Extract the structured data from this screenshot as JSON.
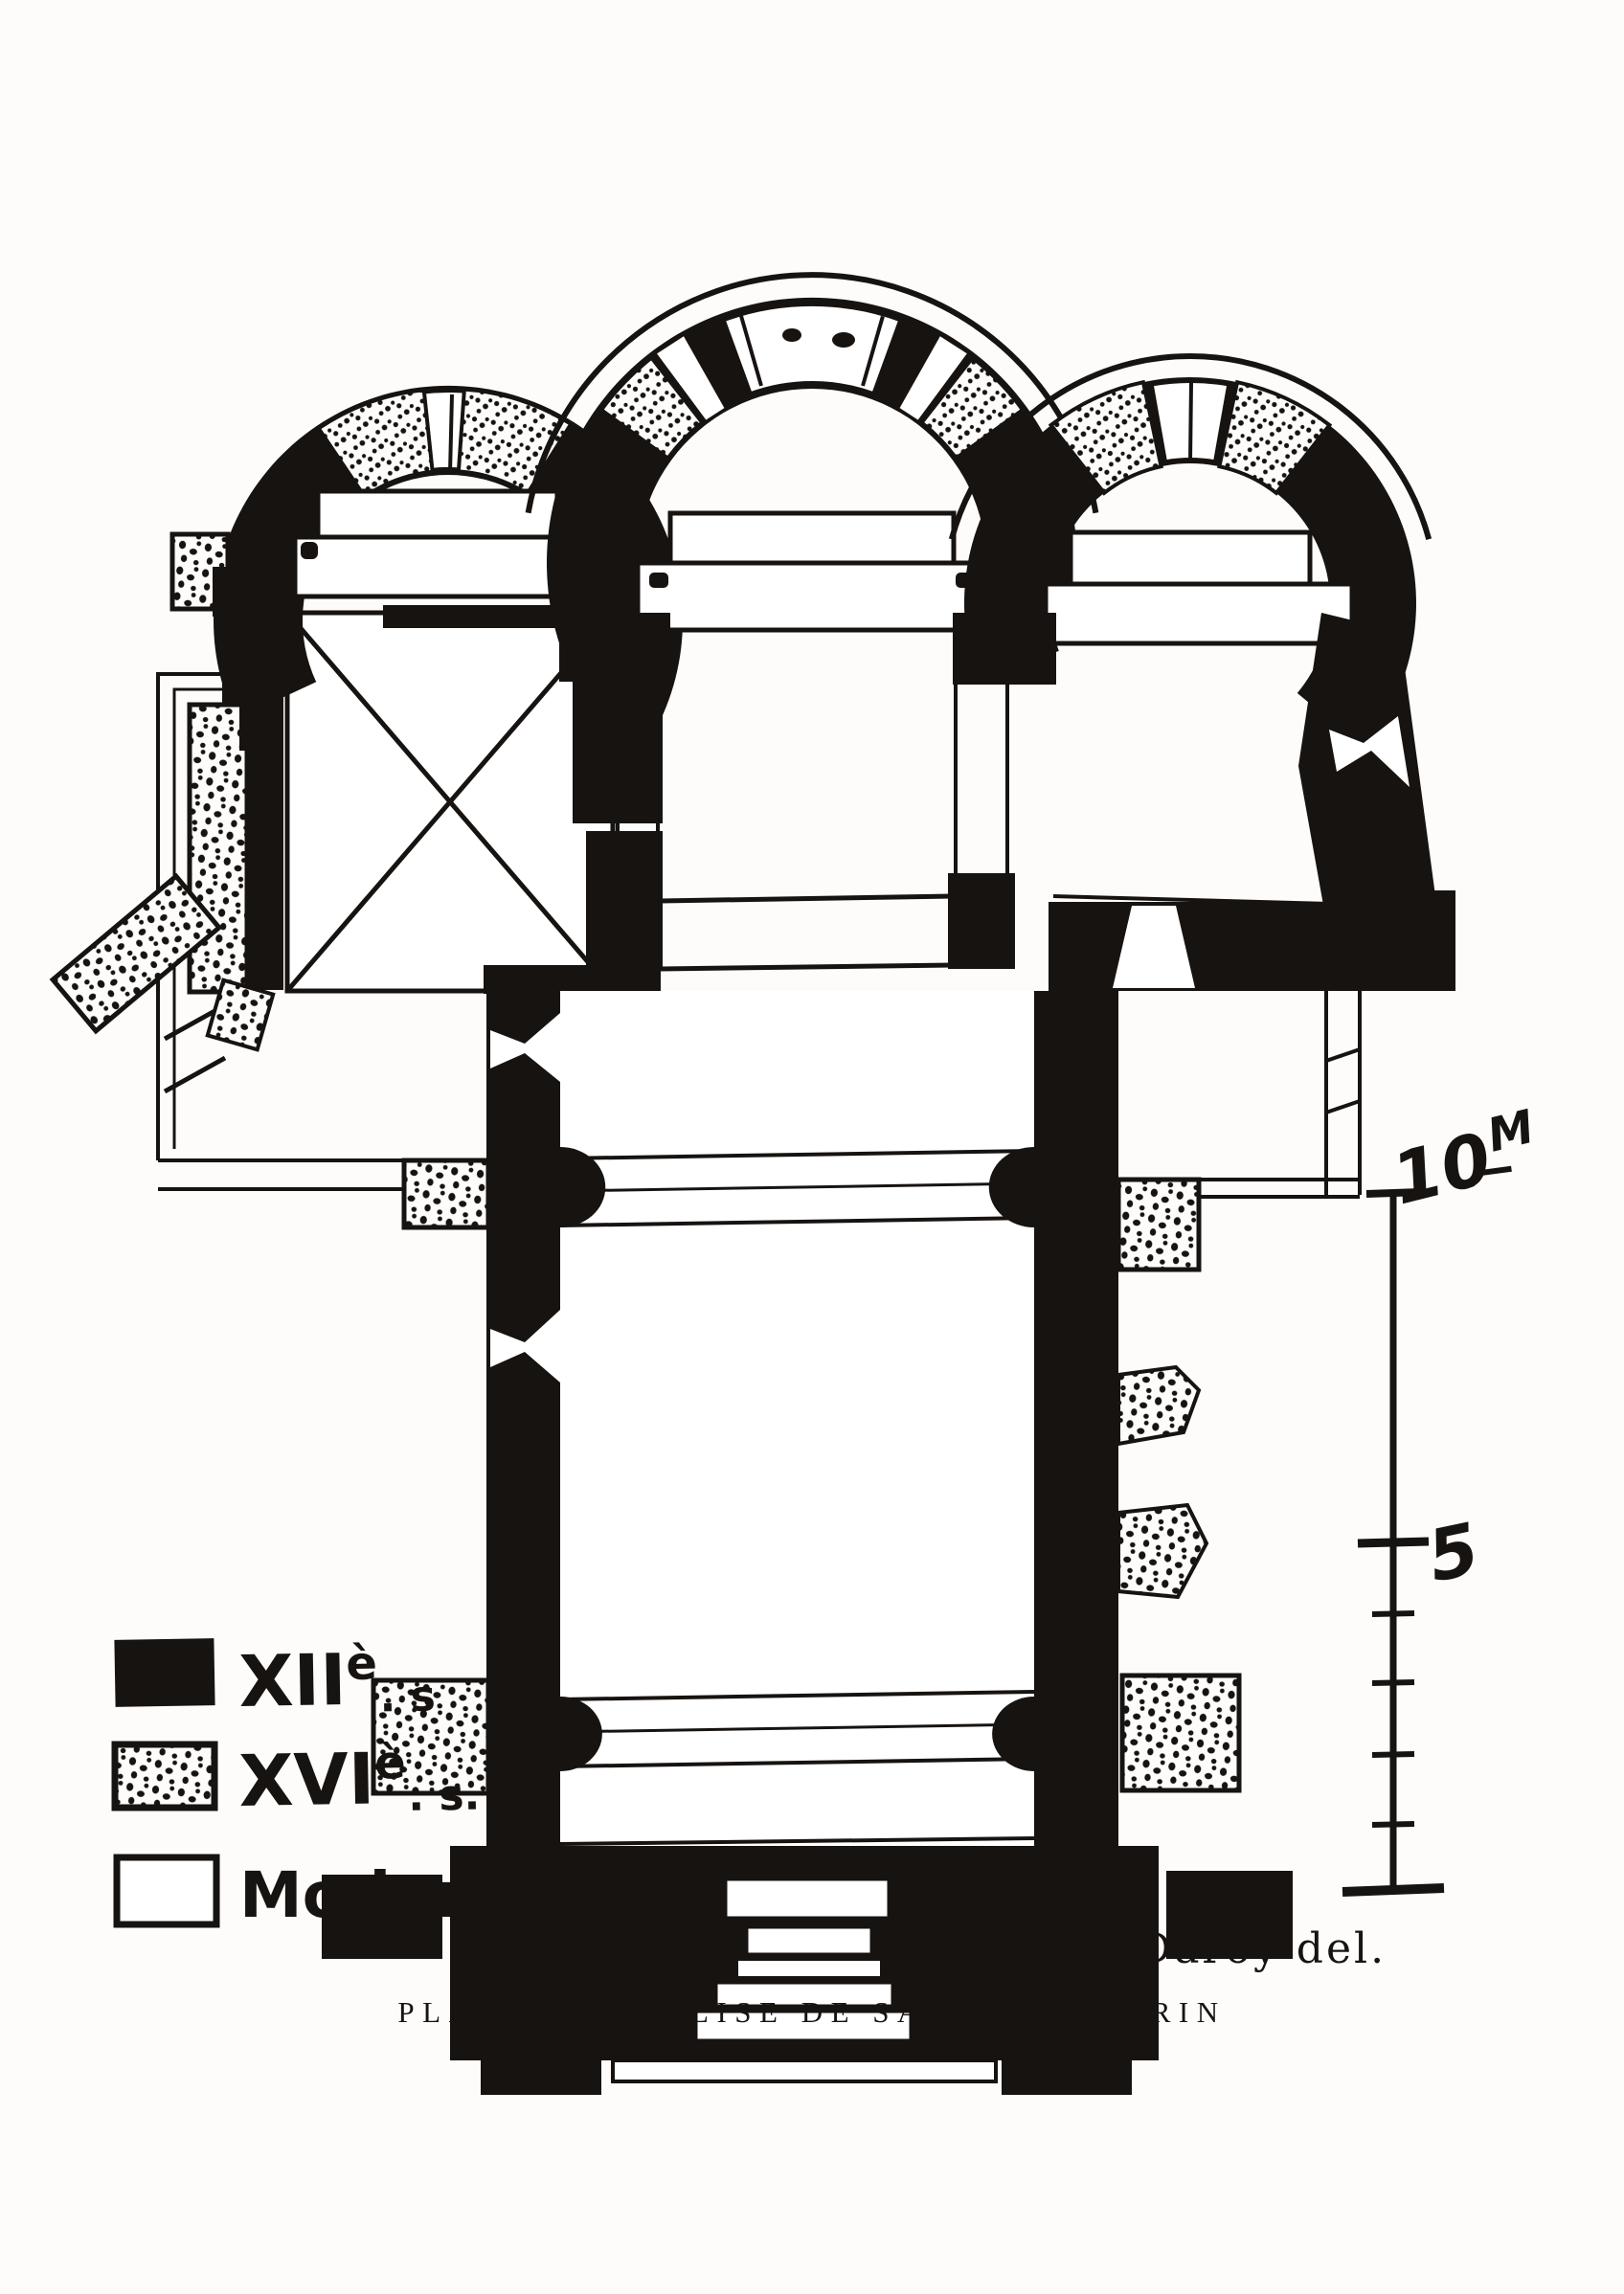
{
  "figure": {
    "caption": "PLAN DE L'ÉGLISE DE SAINT-JEANVRIN",
    "signature": "Daroy del."
  },
  "legend": {
    "items": [
      {
        "id": "12th-century",
        "swatch": "solid-black",
        "prefix": "XII",
        "sup": "è",
        "suffix": ". s"
      },
      {
        "id": "16th-century",
        "swatch": "stippled",
        "prefix": "XVI",
        "sup": "è",
        "suffix": ". s."
      },
      {
        "id": "modern",
        "swatch": "white-outline",
        "prefix": "Moderne",
        "sup": "",
        "suffix": ""
      }
    ]
  },
  "scale": {
    "top_value": "10",
    "top_unit": "M",
    "mid_value": "5"
  },
  "colors": {
    "ink": "#171310",
    "paper": "#fdfcfa"
  }
}
